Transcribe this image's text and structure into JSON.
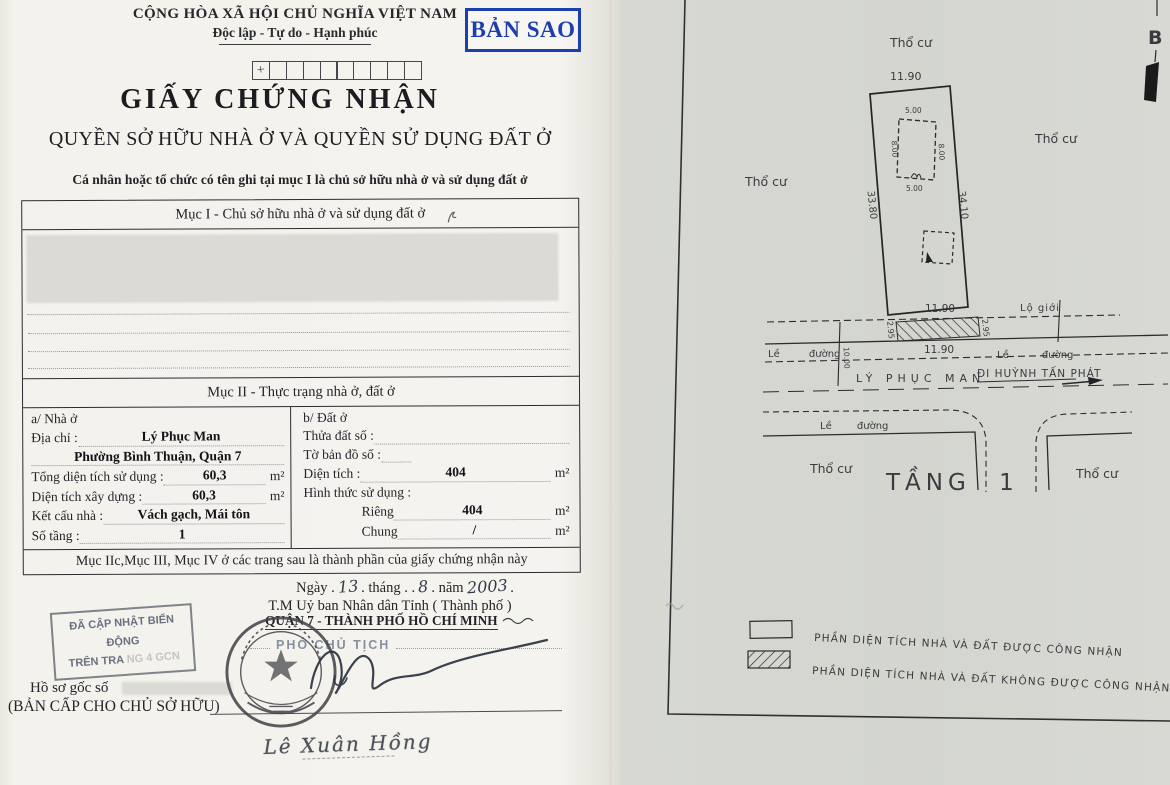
{
  "colors": {
    "stamp_blue": "#1c3eae",
    "page_left_bg": "#f4f2ec",
    "page_right_bg": "#d6d7d1",
    "ink": "#24242a",
    "stamp_gray": "#697080",
    "seal_ink": "#45464c"
  },
  "left_page": {
    "header": {
      "country": "CỘNG HÒA XÃ HỘI CHỦ NGHĨA VIỆT NAM",
      "motto": "Độc lập - Tự do - Hạnh phúc",
      "copy_stamp": "BẢN SAO",
      "serial_mark": "+"
    },
    "title": "GIẤY CHỨNG NHẬN",
    "subtitle": "QUYỀN SỞ HỮU NHÀ Ở VÀ QUYỀN SỬ DỤNG ĐẤT Ở",
    "intro": "Cá nhân hoặc tổ chức có tên ghi tại mục I là chủ sở hữu nhà ở và sử dụng đất ở",
    "section_I": {
      "header": "Mục I - Chủ sở hữu nhà ở và sử dụng đất ở"
    },
    "section_II": {
      "header": "Mục II - Thực trạng nhà ở, đất ở",
      "house": {
        "title": "a/ Nhà ở",
        "rows": {
          "address_label": "Địa chỉ :",
          "address_value": "Lý Phục Man",
          "address_line2": "Phường Bình Thuận,  Quận 7",
          "total_label": "Tổng diện tích sử dụng :",
          "total_value": "60,3",
          "built_label": "Diện tích xây dựng :",
          "built_value": "60,3",
          "structure_label": "Kết cấu nhà :",
          "structure_value": "Vách gạch, Mái tôn",
          "floors_label": "Số tầng :",
          "floors_value": "1",
          "unit": "m²"
        }
      },
      "land": {
        "title": "b/ Đất ở",
        "rows": {
          "plot_label": "Thửa đất số :",
          "map_label": "Tờ bản đồ số :",
          "area_label": "Diện tích :",
          "area_value": "404",
          "use_label": "Hình thức sử dụng :",
          "private_label": "Riêng",
          "private_value": "404",
          "shared_label": "Chung",
          "shared_value": "/",
          "unit": "m²"
        }
      }
    },
    "components_note": "Mục IIc,Mục III, Mục IV ở các trang sau là thành phần của giấy chứng nhận này",
    "signing": {
      "date_prefix": "Ngày .",
      "day": "13",
      "date_mid1": ". tháng . .",
      "month": "8",
      "date_mid2": ". năm",
      "year": "2003",
      "date_suffix": ".",
      "authority": "T.M Uỷ ban Nhân dân Tỉnh ( Thành phố )",
      "district": "QUẬN 7 - THÀNH PHỐ HỒ CHÍ MINH",
      "position": "PHÓ CHỦ TỊCH",
      "signer_name": "Lê Xuân Hồng"
    },
    "update_stamp": {
      "line1": "ĐÃ CẬP NHẬT BIẾN ĐỘNG",
      "line2": "TRÊN TRA",
      "line2_faded": "NG 4 GCN"
    },
    "archive": {
      "dossier_label": "Hồ sơ gốc số",
      "issued_label": "(BẢN CẤP CHO CHỦ SỞ HỮU)"
    }
  },
  "right_page": {
    "north_label": "B",
    "zone_top": "Thổ cư",
    "zone_left": "Thổ cư",
    "zone_right": "Thổ cư",
    "zone_bottom_left": "Thổ cư",
    "zone_bottom_right": "Thổ cư",
    "parcel": {
      "frontage_top": "11.90",
      "side_left": "33.80",
      "side_right": "34.10",
      "frontage_bottom": "11.90",
      "house": {
        "top": "5.00",
        "left": "8.00",
        "right": "8.00",
        "bottom": "5.00"
      }
    },
    "road": {
      "setback_label": "Lộ giới",
      "setback_depth_left": "2.95",
      "setback_depth_right": "2.95",
      "width_label": "11.90",
      "road_depth": "10.00",
      "sidewalk_left": "Lề đường",
      "sidewalk_right": "Lề đường",
      "sidewalk_lower": "Lề đường",
      "street_name": "LÝ PHỤC MAN",
      "direction_label": "ĐI HUỲNH TẤN PHÁT"
    },
    "floor_label": "TẦNG 1",
    "legend": {
      "recognized": "PHẦN DIỆN TÍCH  NHÀ VÀ ĐẤT ĐƯỢC CÔNG NHẬN",
      "not_recognized": "PHẦN DIỆN TÍCH NHÀ VÀ ĐẤT KHÔNG ĐƯỢC CÔNG NHẬN"
    }
  }
}
